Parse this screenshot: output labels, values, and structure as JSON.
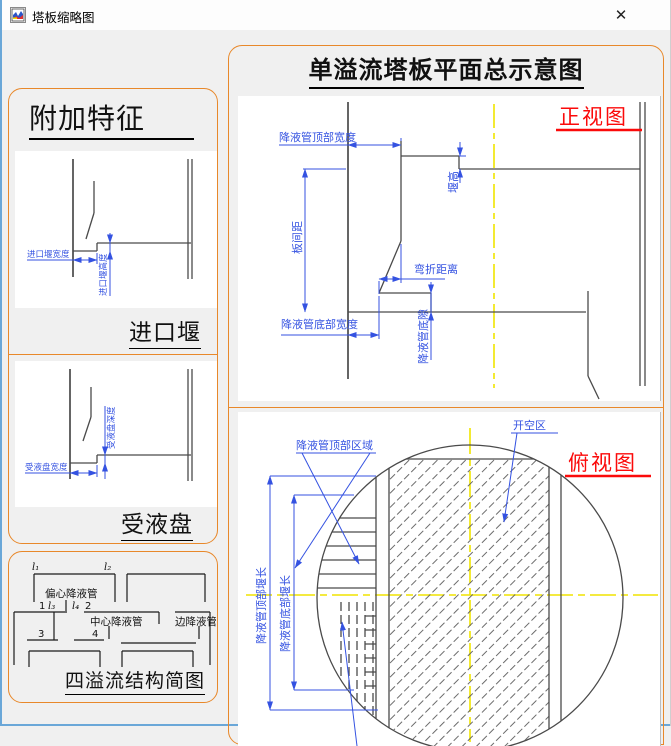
{
  "window": {
    "title": "塔板缩略图",
    "close_glyph": "✕"
  },
  "colors": {
    "panel_border_orange": "#e8882a",
    "dimension_blue": "#3452e1",
    "centerline_yellow": "#f0e400",
    "view_label_red": "#fb0a0a",
    "window_border_blue": "#6aa7d8"
  },
  "left_panel": {
    "title": "附加特征",
    "inlet_weir": {
      "caption": "进口堰",
      "width_label": "进口堰宽度",
      "height_label": "进口堰高度"
    },
    "receiving_pan": {
      "caption": "受液盘",
      "width_label": "受液盘宽度",
      "depth_label": "受液盘深度"
    }
  },
  "four_pass_panel": {
    "title": "四溢流结构简图",
    "eccentric_downcomer": "偏心降液管",
    "center_downcomer": "中心降液管",
    "side_downcomer": "边降液管",
    "l1": "l₁",
    "l2": "l₂",
    "l3": "l₃",
    "l4": "l₄",
    "n1": "1",
    "n2": "2",
    "n3": "3",
    "n4": "4"
  },
  "main_panel": {
    "title": "单溢流塔板平面总示意图",
    "front_view": {
      "label": "正视图",
      "dim_downcomer_top_width": "降液管顶部宽度",
      "dim_tray_spacing": "板间距",
      "dim_weir_height": "堰高",
      "dim_bend_distance": "弯折距离",
      "dim_downcomer_bottom_width": "降液管底部宽度",
      "dim_downcomer_bottom_clearance": "降液管底隙"
    },
    "top_view": {
      "label": "俯视图",
      "ann_downcomer_top_region": "降液管顶部区域",
      "ann_open_area": "开空区",
      "dim_downcomer_top_weir_length": "降液管顶部堰长",
      "dim_downcomer_bottom_weir_length": "降液管底部堰长"
    }
  }
}
